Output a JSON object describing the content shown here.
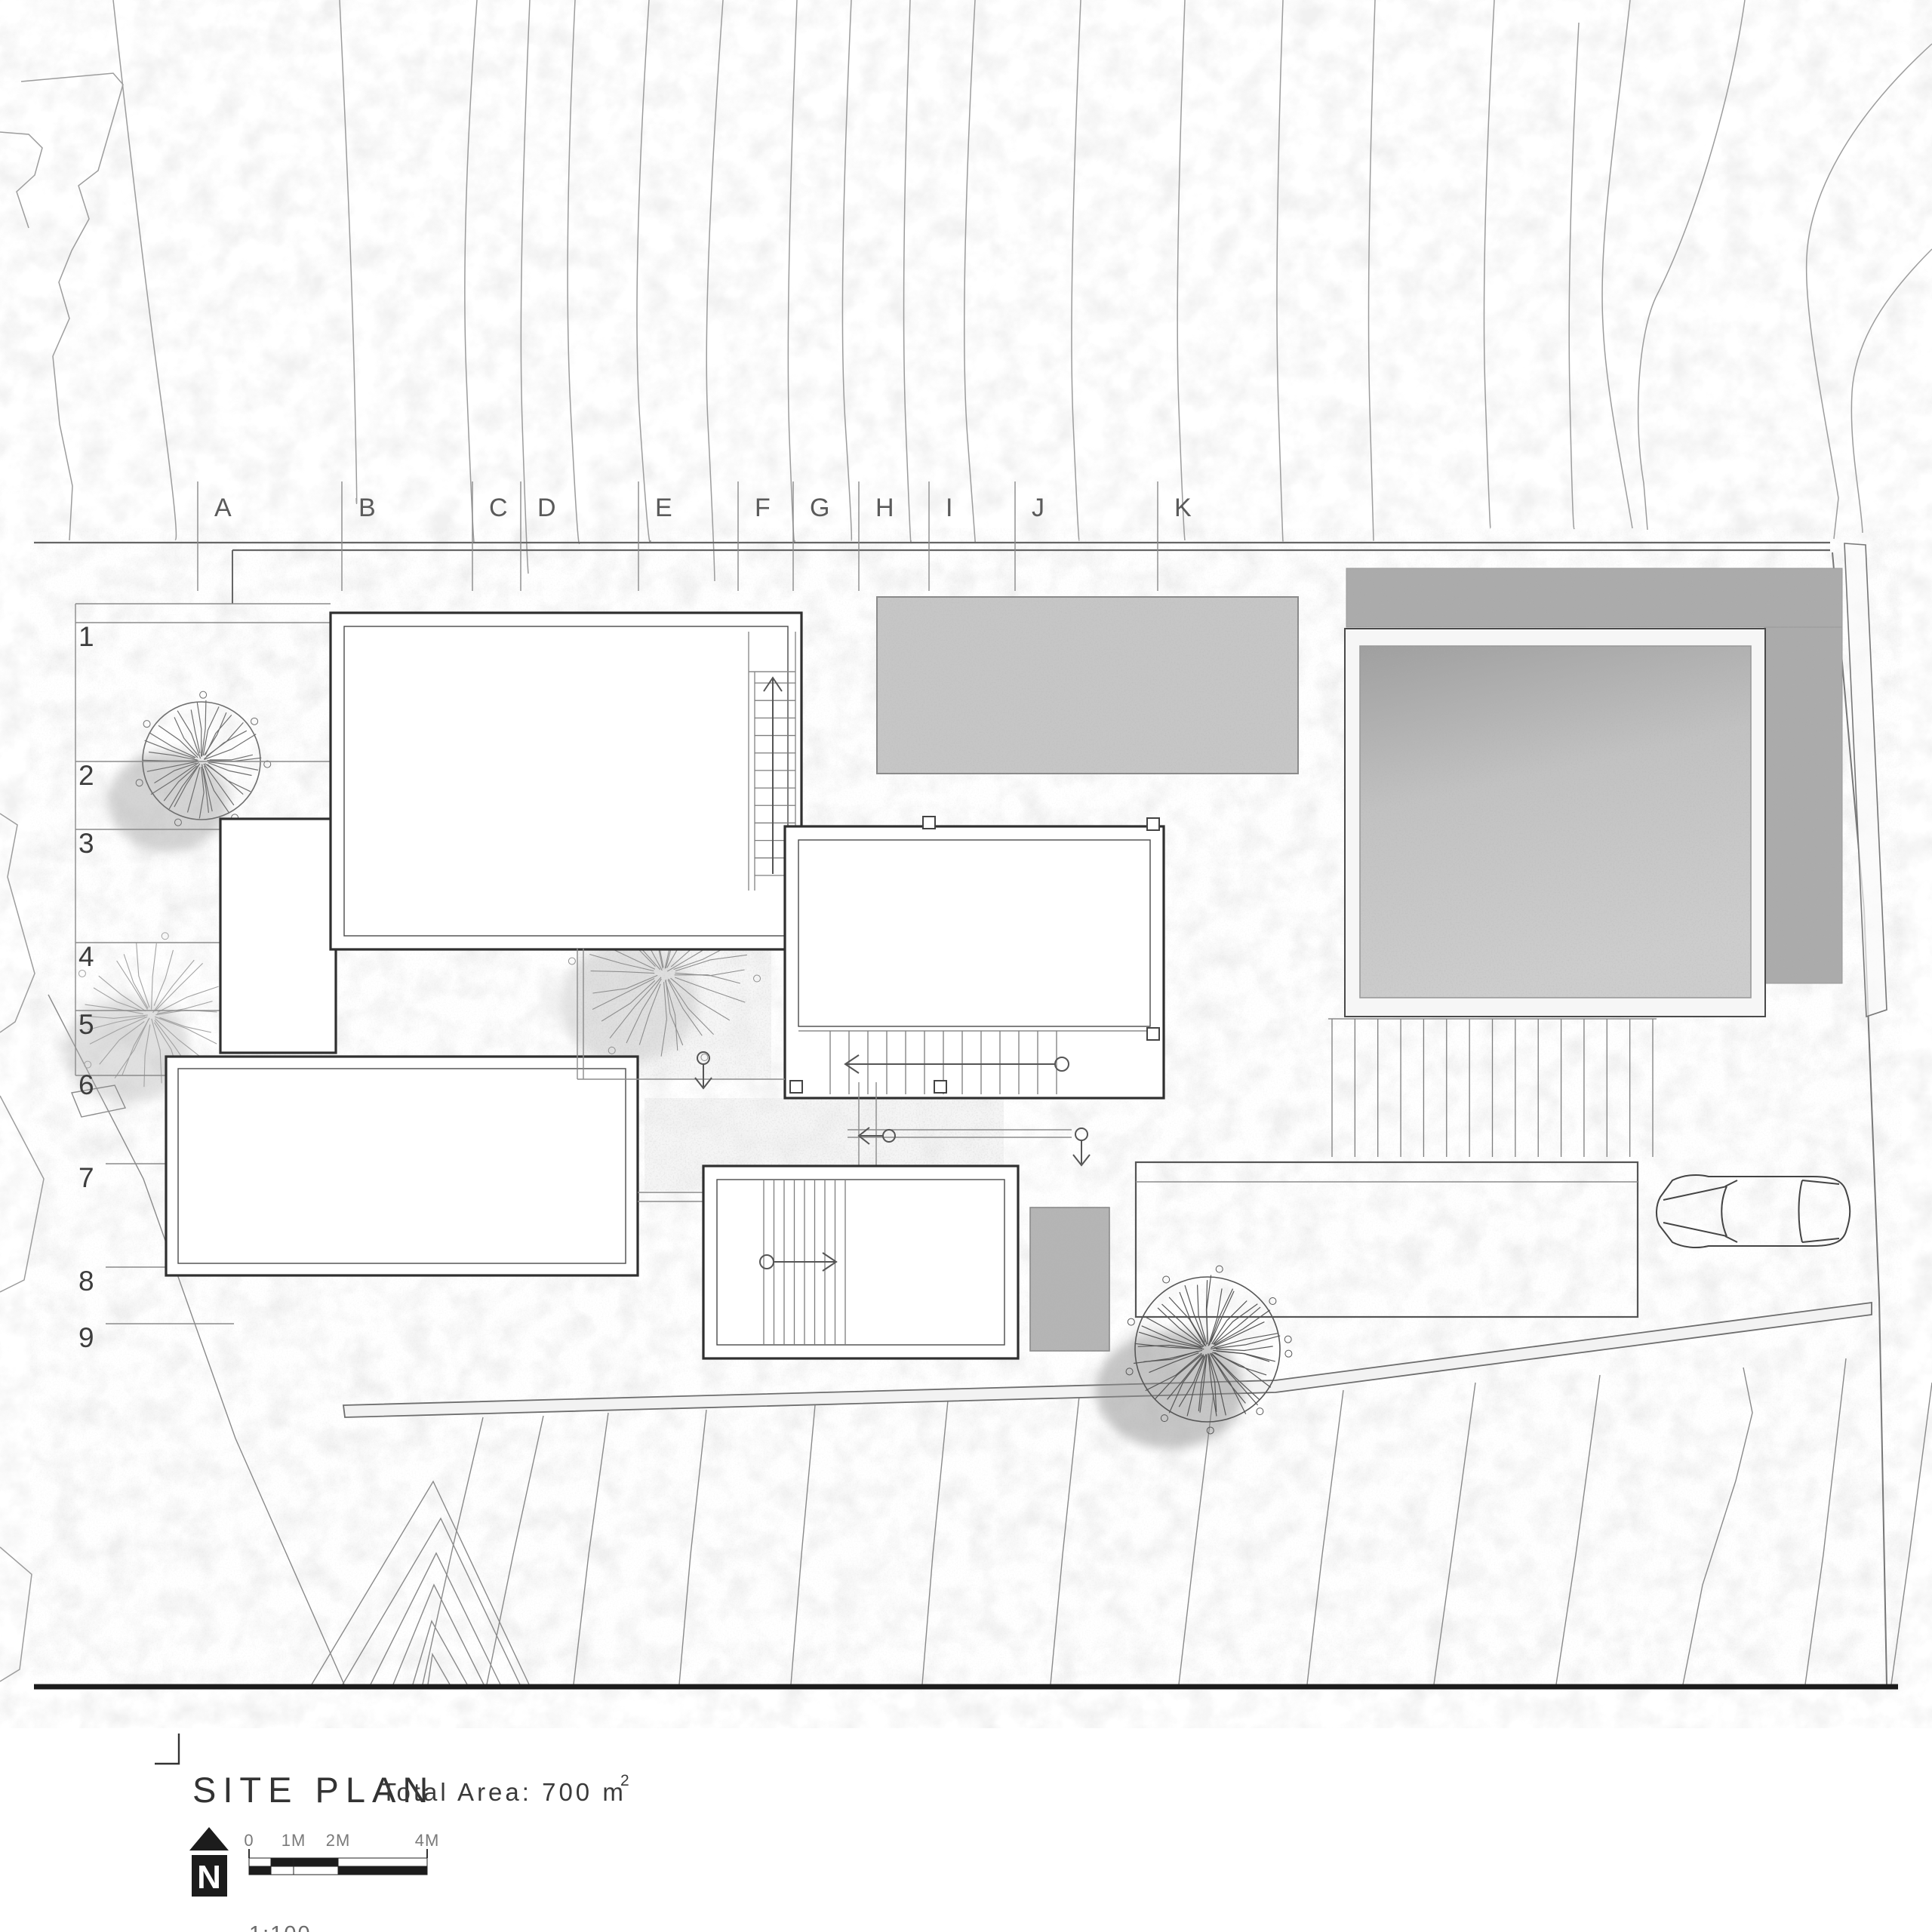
{
  "drawing": {
    "grid": {
      "columns": [
        "A",
        "B",
        "C",
        "D",
        "E",
        "F",
        "G",
        "H",
        "I",
        "J",
        "K"
      ],
      "rows": [
        "1",
        "2",
        "3",
        "4",
        "5",
        "6",
        "7",
        "8",
        "9"
      ]
    },
    "title_block": {
      "title": "SITE PLAN",
      "area_label": "Total Area: 700 m",
      "area_superscript": "2",
      "scale_ratio": "1:100",
      "scale_ticks": [
        "0",
        "1M",
        "2M",
        "4M"
      ],
      "north_letter": "N"
    },
    "colors": {
      "paper": "#ffffff",
      "wall_line": "#2f2f2f",
      "terrain_line": "#9d9d9d",
      "surface_gray": "#c3c3c3",
      "surface_dark": "#abaaaa",
      "ink": "#1c1c1c"
    }
  }
}
